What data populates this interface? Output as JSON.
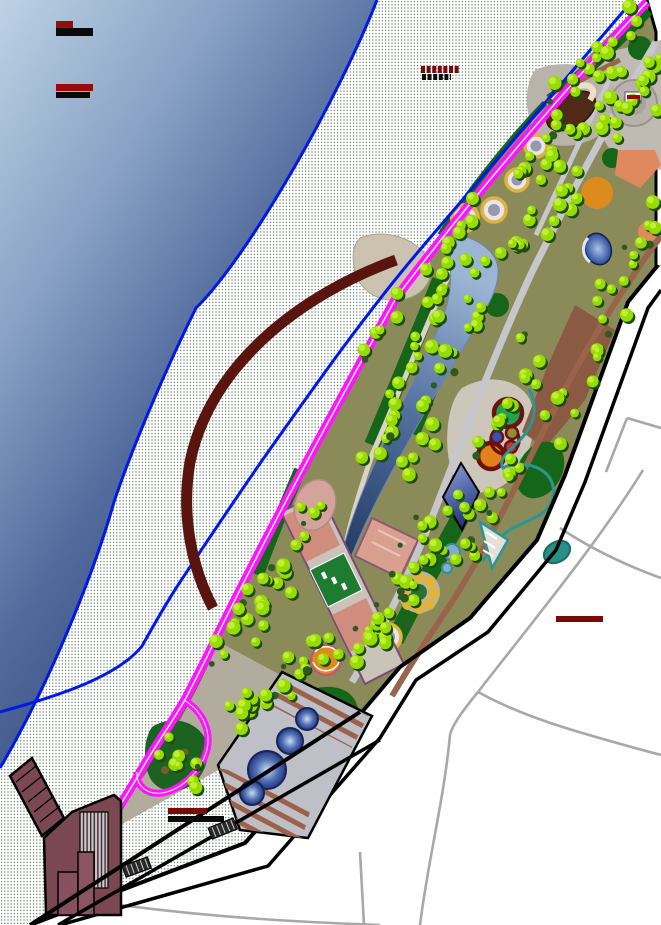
{
  "map": {
    "kind": "park-masterplan-site-drawing",
    "canvas": {
      "width": 661,
      "height": 925
    }
  },
  "palette": {
    "water_light": "#bdd2e4",
    "water_mid": "#6d89b4",
    "water_dark": "#293f6d",
    "shoreline_blue": "#0018e8",
    "beach_dot": "#4a6a50",
    "promenade_magenta": "#ff14ff",
    "promenade_center": "#ffffff",
    "axis_arc_maroon": "#591410",
    "park_base_olive": "#8b8b5a",
    "lawn_green": "#166619",
    "tree_green": "#96dc00",
    "tree_shadow": "#1c4a0a",
    "tree_highlight": "#c9f23e",
    "path_gray": "#c6c6cc",
    "path_brown": "#9a644c",
    "path_tan": "#d9d2c6",
    "lake_light": "#9cb5d5",
    "lake_dark": "#1d3560",
    "boundary_black": "#000000",
    "street_gray": "#a8a8a8",
    "urban_white": "#ffffff",
    "building_plum": "#7b4752",
    "stream_teal": "#2a9595",
    "plaza_orange": "#dd8b1f",
    "plaza_salmon": "#e0885e",
    "fountain_ring_yellow": "#dfb33c",
    "court_green": "#1d7c2f",
    "court_pink": "#d08d7e",
    "court_outline": "#7c4878",
    "playground_ring_maroon": "#6b1111",
    "label_red": "#8f0a0a",
    "label_black": "#0a0a0a"
  },
  "redacted_labels": [
    {
      "id": "waterbody-label-1",
      "dashed": false,
      "bars": [
        {
          "x": 56,
          "y": 21,
          "w": 17,
          "h": 7,
          "color": "#9a0a0a"
        },
        {
          "x": 56,
          "y": 28,
          "w": 37,
          "h": 8,
          "color": "#0a0a0a"
        }
      ]
    },
    {
      "id": "waterbody-label-2",
      "dashed": false,
      "bars": [
        {
          "x": 56,
          "y": 84,
          "w": 37,
          "h": 7,
          "color": "#9a0a0a"
        },
        {
          "x": 56,
          "y": 92,
          "w": 34,
          "h": 6,
          "color": "#0a0a0a"
        }
      ]
    },
    {
      "id": "beach-label",
      "dashed": true,
      "bars": [
        {
          "x": 421,
          "y": 66,
          "w": 38,
          "h": 7,
          "color": "#7a0a0a"
        },
        {
          "x": 422,
          "y": 74,
          "w": 29,
          "h": 6,
          "color": "#0a0a0a"
        }
      ]
    },
    {
      "id": "plaza-building-marker",
      "dashed": false,
      "bars": [
        {
          "x": 627,
          "y": 95,
          "w": 13,
          "h": 4,
          "color": "#9a0a0a"
        }
      ]
    },
    {
      "id": "district-label",
      "dashed": false,
      "bars": [
        {
          "x": 556,
          "y": 616,
          "w": 47,
          "h": 6,
          "color": "#7a0a0a"
        }
      ]
    },
    {
      "id": "entrance-label",
      "dashed": false,
      "bars": [
        {
          "x": 168,
          "y": 808,
          "w": 39,
          "h": 6,
          "color": "#7a0a0a"
        },
        {
          "x": 168,
          "y": 816,
          "w": 56,
          "h": 6,
          "color": "#0a0a0a"
        }
      ]
    }
  ],
  "vegetation": {
    "clusters": [
      [
        642,
        18,
        552,
        104,
        16,
        13
      ],
      [
        656,
        48,
        612,
        126,
        10,
        12
      ],
      [
        622,
        98,
        532,
        182,
        16,
        16
      ],
      [
        586,
        176,
        496,
        256,
        16,
        18
      ],
      [
        652,
        205,
        602,
        302,
        12,
        14
      ],
      [
        614,
        322,
        550,
        432,
        12,
        16
      ],
      [
        456,
        256,
        370,
        462,
        24,
        13
      ],
      [
        490,
        272,
        410,
        470,
        20,
        14
      ],
      [
        542,
        332,
        470,
        452,
        14,
        18
      ],
      [
        530,
        456,
        450,
        562,
        16,
        16
      ],
      [
        450,
        488,
        362,
        640,
        26,
        20
      ],
      [
        314,
        508,
        254,
        636,
        16,
        13
      ],
      [
        340,
        642,
        230,
        718,
        24,
        18
      ],
      [
        282,
        560,
        207,
        658,
        12,
        10
      ],
      [
        162,
        742,
        202,
        782,
        9,
        11
      ],
      [
        422,
        572,
        362,
        660,
        12,
        14
      ],
      [
        562,
        122,
        522,
        172,
        6,
        10
      ],
      [
        482,
        206,
        432,
        262,
        8,
        10
      ],
      [
        606,
        62,
        655,
        102,
        6,
        10
      ],
      [
        395,
        300,
        362,
        360,
        6,
        9
      ]
    ]
  }
}
